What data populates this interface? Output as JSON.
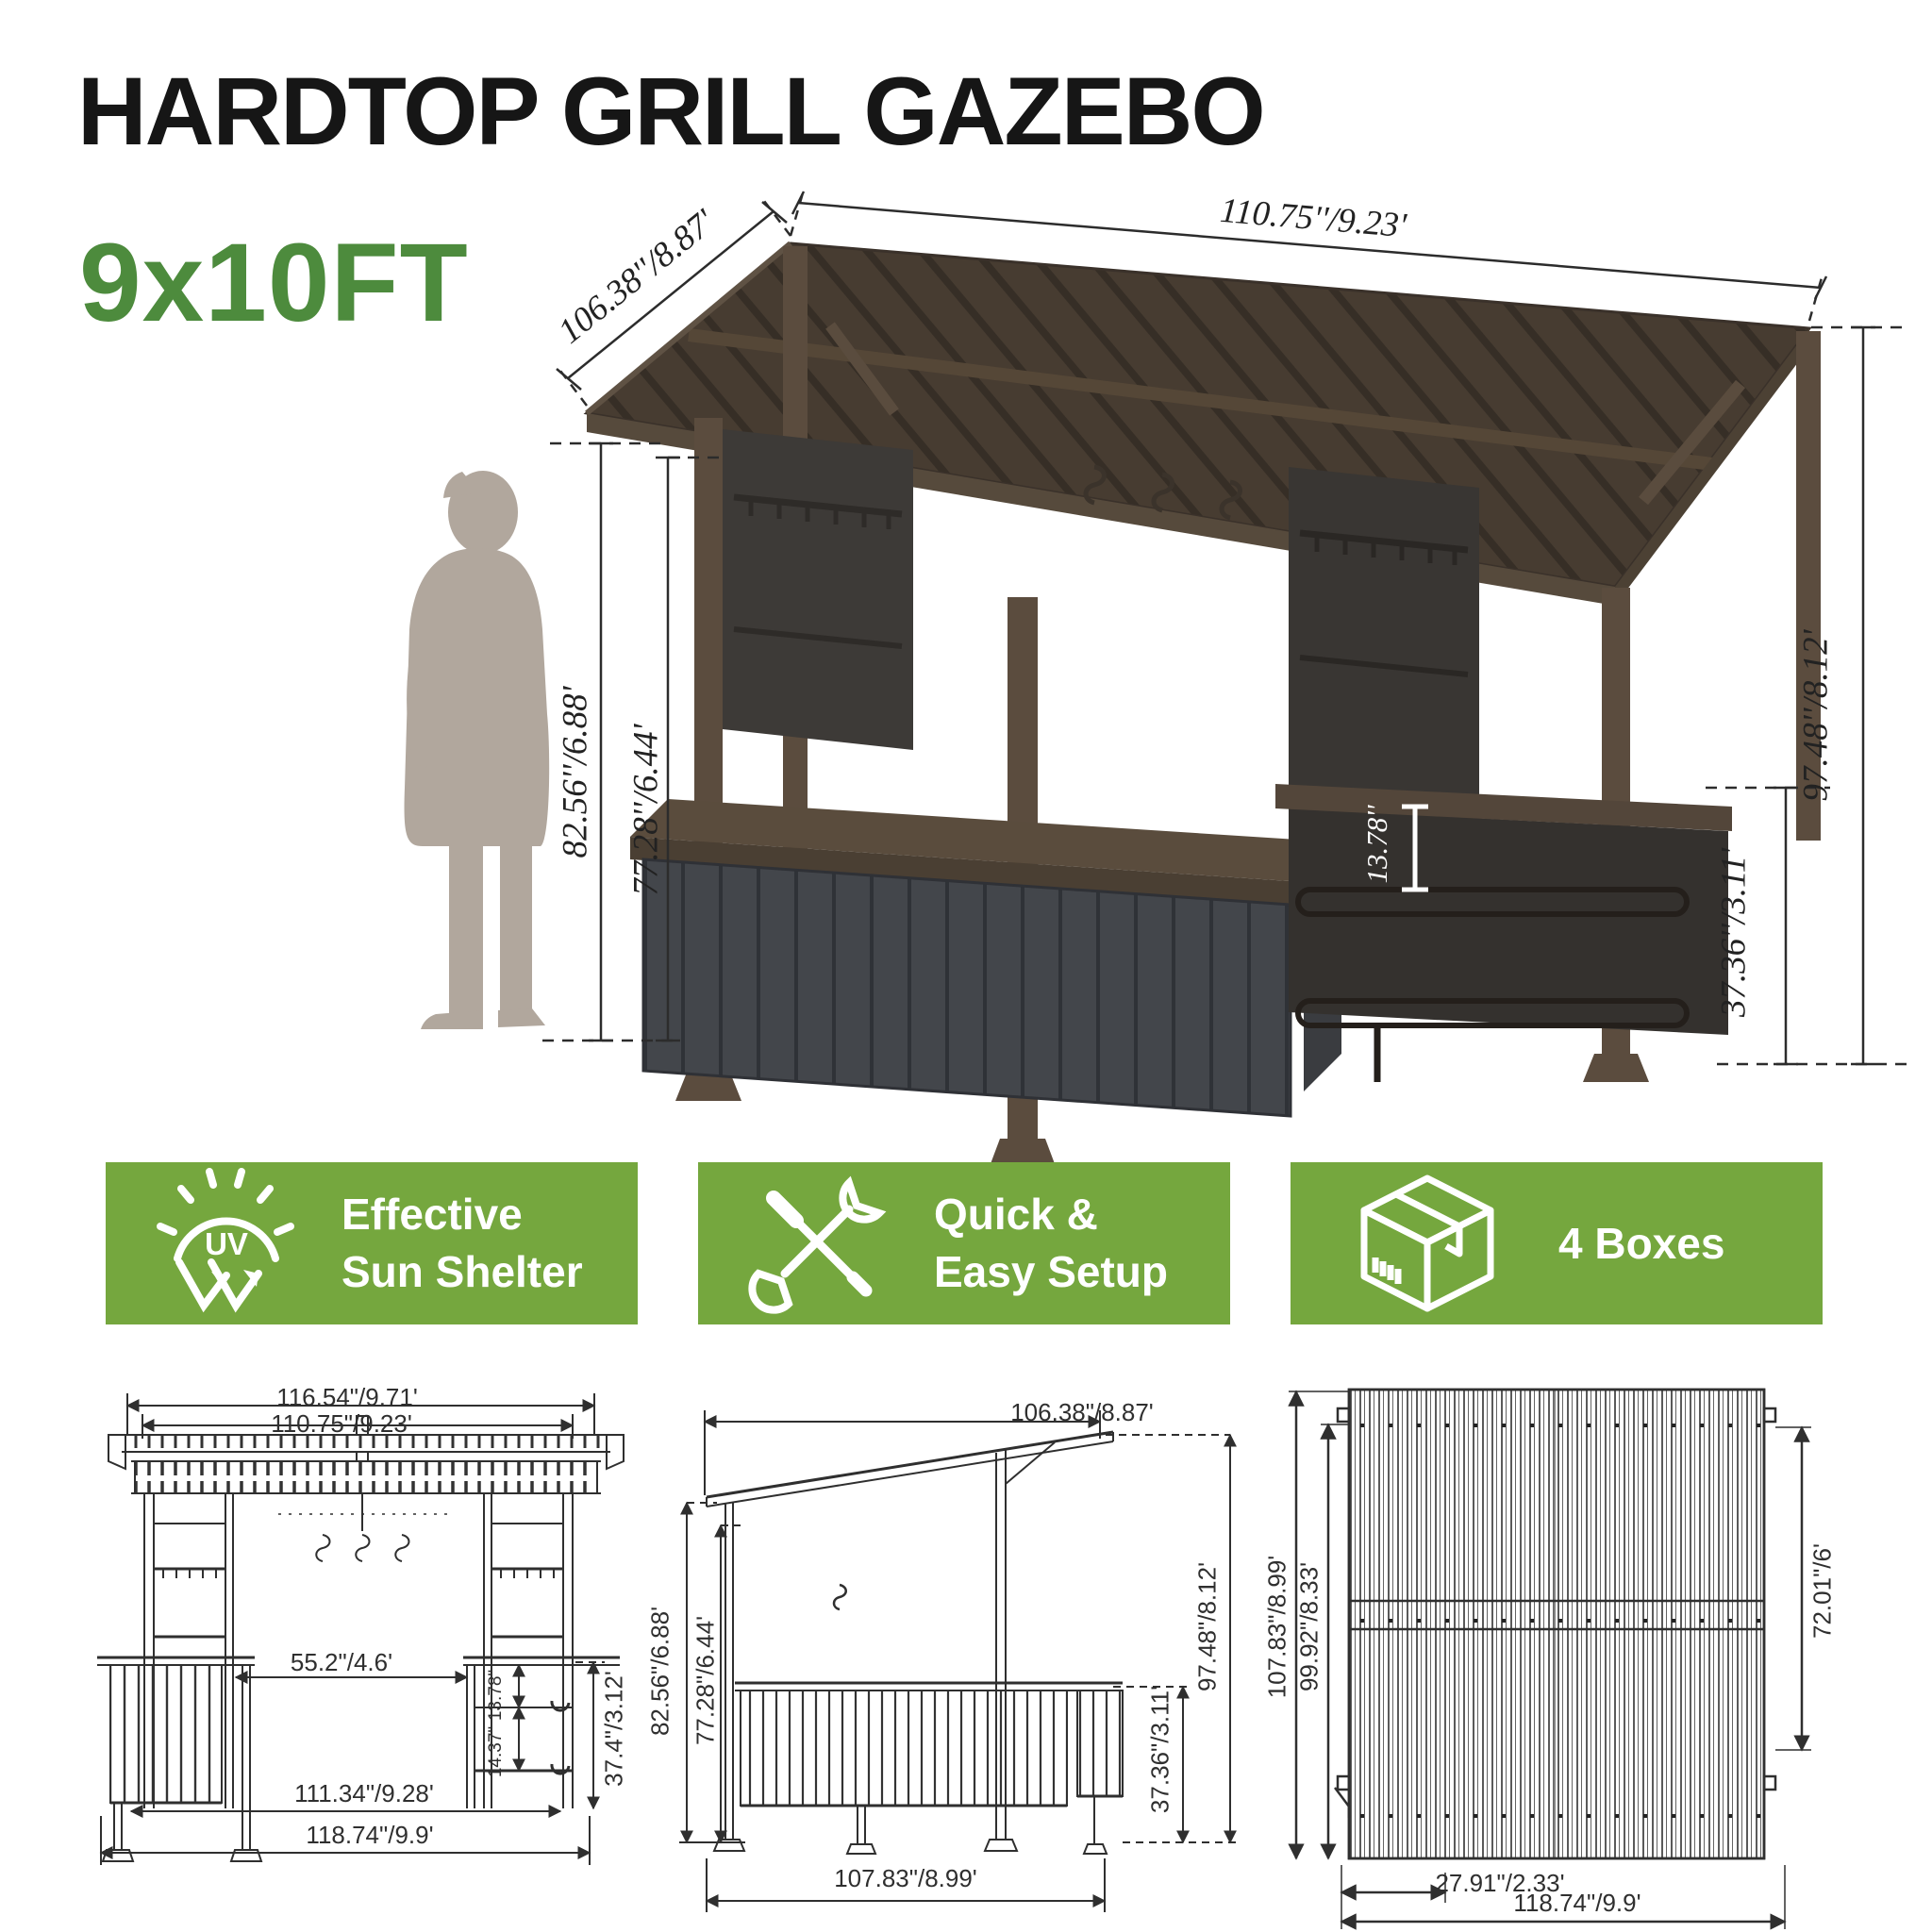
{
  "header": {
    "title": "HARDTOP GRILL GAZEBO",
    "size_label": "9x10FT"
  },
  "colors": {
    "banner_green": "#75a73e",
    "size_green": "#4d8b3d",
    "frame_brown": "#5b4c3e",
    "panel_gray": "#43464b",
    "silhouette_gray": "#b1a79d"
  },
  "main_diagram": {
    "dims": {
      "roof_width": "110.75''/9.23'",
      "roof_depth": "106.38''/8.87'",
      "height_left_outer": "82.56''/6.88'",
      "height_left_inner": "77.28''/6.44'",
      "height_right": "97.48''/8.12'",
      "counter_height_right": "37.36''/3.11'",
      "shelf_gap": "13.78''"
    }
  },
  "features": {
    "items": [
      {
        "icon": "uv-sun-icon",
        "uv_label": "UV",
        "line1": "Effective",
        "line2": "Sun Shelter"
      },
      {
        "icon": "tools-icon",
        "line1": "Quick &",
        "line2": "Easy Setup"
      },
      {
        "icon": "box-icon",
        "line1": "4 Boxes",
        "line2": ""
      }
    ]
  },
  "drawings": {
    "front_view": {
      "dim_top_outer": "116.54\"/9.71'",
      "dim_top_inner": "110.75\"/9.23'",
      "dim_opening": "55.2\"/4.6'",
      "dim_shelf_top": "13.78\"",
      "dim_shelf_mid": "14.37\"",
      "dim_counter_height": "37.4\"/3.12'",
      "dim_bottom_inner": "111.34\"/9.28'",
      "dim_bottom_outer": "118.74\"/9.9'"
    },
    "side_view": {
      "dim_top": "106.38\"/8.87'",
      "dim_height_outer": "82.56\"/6.88'",
      "dim_height_inner": "77.28\"/6.44'",
      "dim_height_right": "97.48\"/8.12'",
      "dim_counter": "37.36\"/3.11'",
      "dim_bottom": "107.83\"/8.99'"
    },
    "top_view": {
      "dim_side_outer": "107.83\"/8.99'",
      "dim_side_inner": "99.92\"/8.33'",
      "dim_right": "72.01\"/6'",
      "dim_overhang": "27.91\"/2.33'",
      "dim_bottom": "118.74\"/9.9'"
    }
  }
}
